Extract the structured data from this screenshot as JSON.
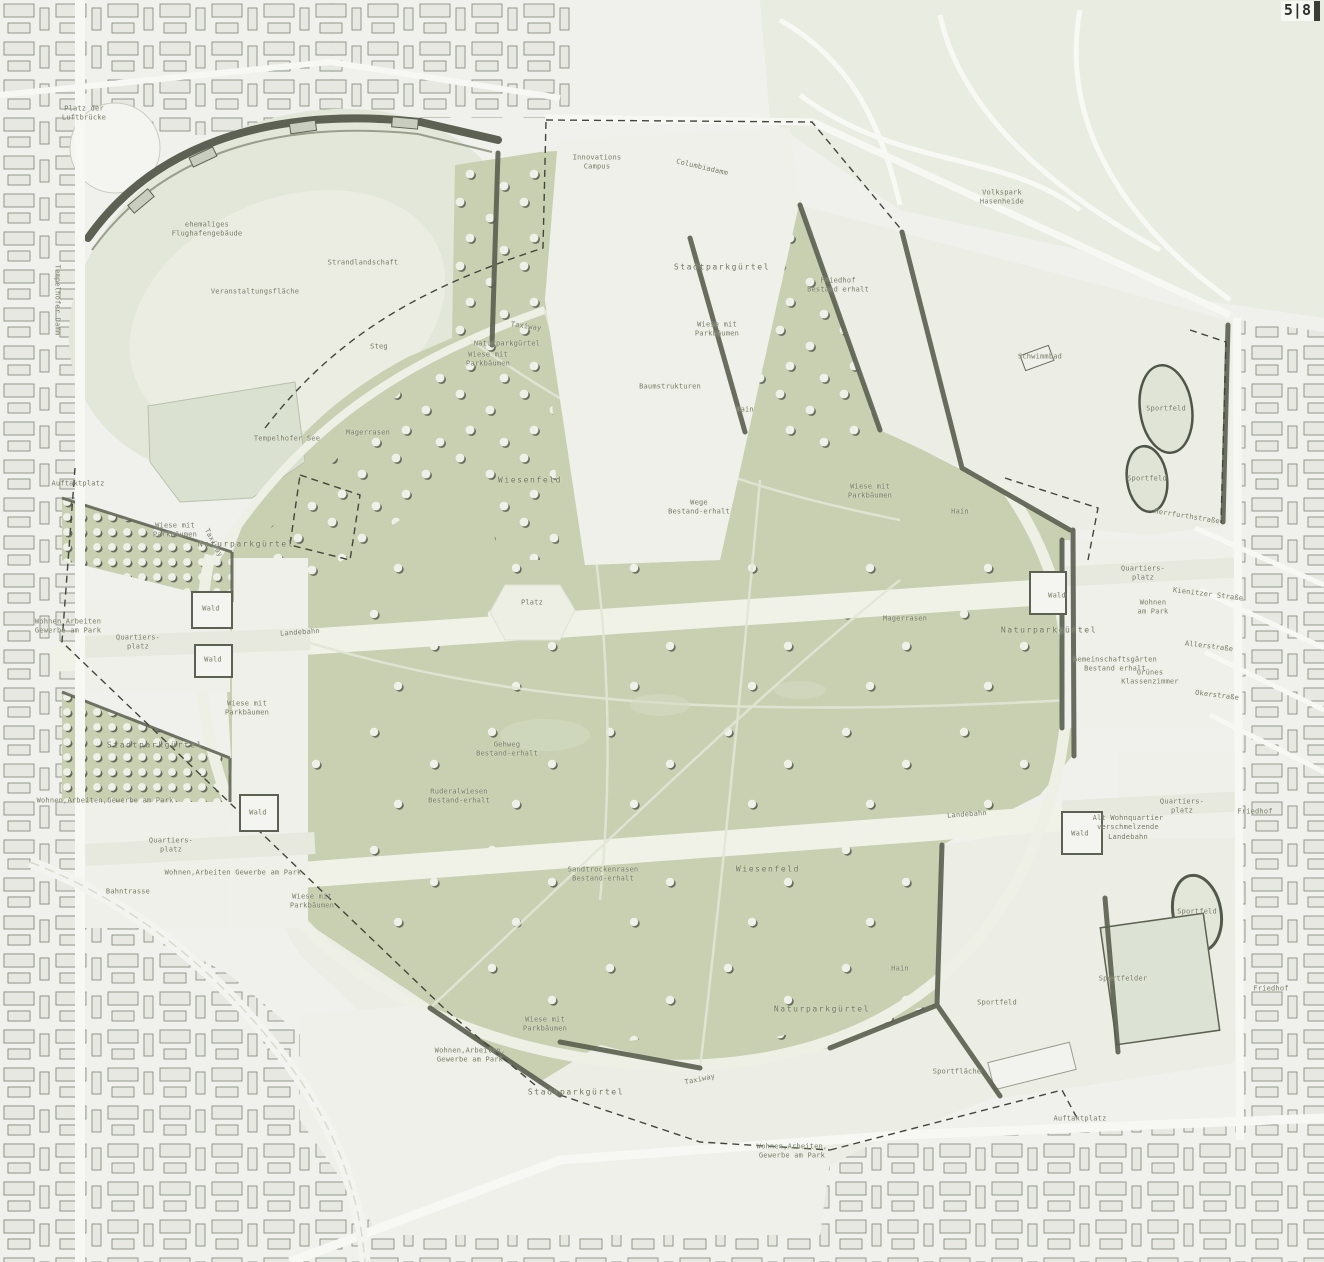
{
  "page": {
    "marker": "5|8"
  },
  "map": {
    "colors": {
      "meadow_green": "#c8d0b1",
      "light_green": "#e3e7d9",
      "forest_speckle_bg": "#eceee5",
      "speckle_ink": "#565b4c",
      "city_bg": "#f0f1ed",
      "building_ink": "#5d6153",
      "runway_white": "#f0f2e8",
      "water": "#dbe1d0",
      "label_ink": "#767b66"
    },
    "labels": [
      {
        "x": 84,
        "y": 114,
        "t": "Platz der\nLuftbrücke"
      },
      {
        "x": 207,
        "y": 230,
        "t": "ehemaliges\nFlughafengebäude"
      },
      {
        "x": 363,
        "y": 263,
        "t": "Strandlandschaft"
      },
      {
        "x": 255,
        "y": 292,
        "t": "Veranstaltungsfläche"
      },
      {
        "x": 379,
        "y": 347,
        "t": "Steg"
      },
      {
        "x": 287,
        "y": 439,
        "t": "Tempelhofer See"
      },
      {
        "x": 368,
        "y": 433,
        "t": "Magerrasen"
      },
      {
        "x": 530,
        "y": 481,
        "t": "Wiesenfeld",
        "lg": 1
      },
      {
        "x": 597,
        "y": 163,
        "t": "Innovations\nCampus"
      },
      {
        "x": 702,
        "y": 168,
        "t": "Columbiadamm",
        "r": 13
      },
      {
        "x": 722,
        "y": 268,
        "t": "Stadtparkgürtel",
        "lg": 1
      },
      {
        "x": 838,
        "y": 286,
        "t": "Friedhof\nBestand erhalt"
      },
      {
        "x": 1002,
        "y": 198,
        "t": "Volkspark\nHasenheide"
      },
      {
        "x": 526,
        "y": 327,
        "t": "Taxiway",
        "r": 8
      },
      {
        "x": 507,
        "y": 344,
        "t": "Naturparkgürtel"
      },
      {
        "x": 488,
        "y": 360,
        "t": "Wiese mit\nParkbäumen"
      },
      {
        "x": 717,
        "y": 330,
        "t": "Wiese mit\nParkbäumen"
      },
      {
        "x": 670,
        "y": 387,
        "t": "Baumstrukturen"
      },
      {
        "x": 745,
        "y": 410,
        "t": "Hain"
      },
      {
        "x": 699,
        "y": 508,
        "t": "Wege\nBestand-erhalt"
      },
      {
        "x": 870,
        "y": 492,
        "t": "Wiese mit\nParkbäumen"
      },
      {
        "x": 960,
        "y": 512,
        "t": "Hain"
      },
      {
        "x": 1040,
        "y": 357,
        "t": "Schwimmbad"
      },
      {
        "x": 1166,
        "y": 409,
        "t": "Sportfeld"
      },
      {
        "x": 1147,
        "y": 479,
        "t": "Sportfeld"
      },
      {
        "x": 1187,
        "y": 517,
        "t": "Herrfurthstraße",
        "r": 9
      },
      {
        "x": 1143,
        "y": 574,
        "t": "Quartiers-\nplatz"
      },
      {
        "x": 1153,
        "y": 608,
        "t": "Wohnen\nam Park"
      },
      {
        "x": 1208,
        "y": 595,
        "t": "Kienitzer Straße",
        "r": 7
      },
      {
        "x": 1209,
        "y": 647,
        "t": "Allerstraße",
        "r": 7
      },
      {
        "x": 1217,
        "y": 696,
        "t": "Okerstraße",
        "r": 7
      },
      {
        "x": 1049,
        "y": 631,
        "t": "Naturparkgürtel",
        "lg": 1
      },
      {
        "x": 1057,
        "y": 596,
        "t": "Wald"
      },
      {
        "x": 1115,
        "y": 665,
        "t": "Gemeinschaftsgärten\nBestand erhalt"
      },
      {
        "x": 1150,
        "y": 678,
        "t": "Grünes\nKlassenzimmer"
      },
      {
        "x": 78,
        "y": 484,
        "t": "Auftaktplatz"
      },
      {
        "x": 175,
        "y": 531,
        "t": "Wiese mit\nParkbäumen"
      },
      {
        "x": 213,
        "y": 543,
        "t": "Taxiway",
        "r": 62
      },
      {
        "x": 246,
        "y": 545,
        "t": "Naturparkgürtel",
        "lg": 1
      },
      {
        "x": 211,
        "y": 609,
        "t": "Wald"
      },
      {
        "x": 68,
        "y": 627,
        "t": "Wohnen Arbeiten\nGewerbe am Park"
      },
      {
        "x": 138,
        "y": 643,
        "t": "Quartiers-\nplatz"
      },
      {
        "x": 213,
        "y": 660,
        "t": "Wald"
      },
      {
        "x": 300,
        "y": 633,
        "t": "Landebahn",
        "r": -4
      },
      {
        "x": 532,
        "y": 603,
        "t": "Platz"
      },
      {
        "x": 905,
        "y": 619,
        "t": "Magerrasen"
      },
      {
        "x": 247,
        "y": 709,
        "t": "Wiese mit\nParkbäumen"
      },
      {
        "x": 155,
        "y": 746,
        "t": "Stadtparkgürtel",
        "lg": 1
      },
      {
        "x": 105,
        "y": 801,
        "t": "Wohnen,Arbeiten,Gewerbe am Park"
      },
      {
        "x": 258,
        "y": 813,
        "t": "Wald"
      },
      {
        "x": 171,
        "y": 846,
        "t": "Quartiers-\nplatz"
      },
      {
        "x": 233,
        "y": 873,
        "t": "Wohnen,Arbeiten Gewerbe am Park"
      },
      {
        "x": 128,
        "y": 892,
        "t": "Bahntrasse"
      },
      {
        "x": 312,
        "y": 902,
        "t": "Wiese mit\nParkbäumen"
      },
      {
        "x": 507,
        "y": 750,
        "t": "Gehweg\nBestand-erhalt"
      },
      {
        "x": 459,
        "y": 797,
        "t": "Ruderalwiesen\nBestand-erhalt"
      },
      {
        "x": 603,
        "y": 875,
        "t": "Sandtrockenrasen\nBestand-erhalt"
      },
      {
        "x": 768,
        "y": 870,
        "t": "Wiesenfeld",
        "lg": 1
      },
      {
        "x": 967,
        "y": 815,
        "t": "Landebahn",
        "r": -4
      },
      {
        "x": 1128,
        "y": 828,
        "t": "Alt Wohnquartier\nverschmelzende\nLandebahn"
      },
      {
        "x": 1182,
        "y": 807,
        "t": "Quartiers-\nplatz"
      },
      {
        "x": 1080,
        "y": 834,
        "t": "Wald"
      },
      {
        "x": 1255,
        "y": 812,
        "t": "Friedhof"
      },
      {
        "x": 545,
        "y": 1025,
        "t": "Wiese mit\nParkbäumen"
      },
      {
        "x": 470,
        "y": 1056,
        "t": "Wohnen,Arbeiten,\nGewerbe am Park"
      },
      {
        "x": 576,
        "y": 1093,
        "t": "Stadtparkgürtel",
        "lg": 1
      },
      {
        "x": 700,
        "y": 1080,
        "t": "Taxiway",
        "r": -12
      },
      {
        "x": 822,
        "y": 1010,
        "t": "Naturparkgürtel",
        "lg": 1
      },
      {
        "x": 900,
        "y": 969,
        "t": "Hain"
      },
      {
        "x": 997,
        "y": 1003,
        "t": "Sportfeld"
      },
      {
        "x": 957,
        "y": 1072,
        "t": "Sportfläche"
      },
      {
        "x": 1123,
        "y": 979,
        "t": "Sportfelder"
      },
      {
        "x": 1197,
        "y": 912,
        "t": "Sportfeld"
      },
      {
        "x": 1271,
        "y": 989,
        "t": "Friedhof"
      },
      {
        "x": 1080,
        "y": 1119,
        "t": "Auftaktplatz"
      },
      {
        "x": 792,
        "y": 1152,
        "t": "Wohnen,Arbeiten,\nGewerbe am Park"
      },
      {
        "x": 57,
        "y": 300,
        "t": "Tempelhofer Damm",
        "r": 90
      }
    ]
  }
}
